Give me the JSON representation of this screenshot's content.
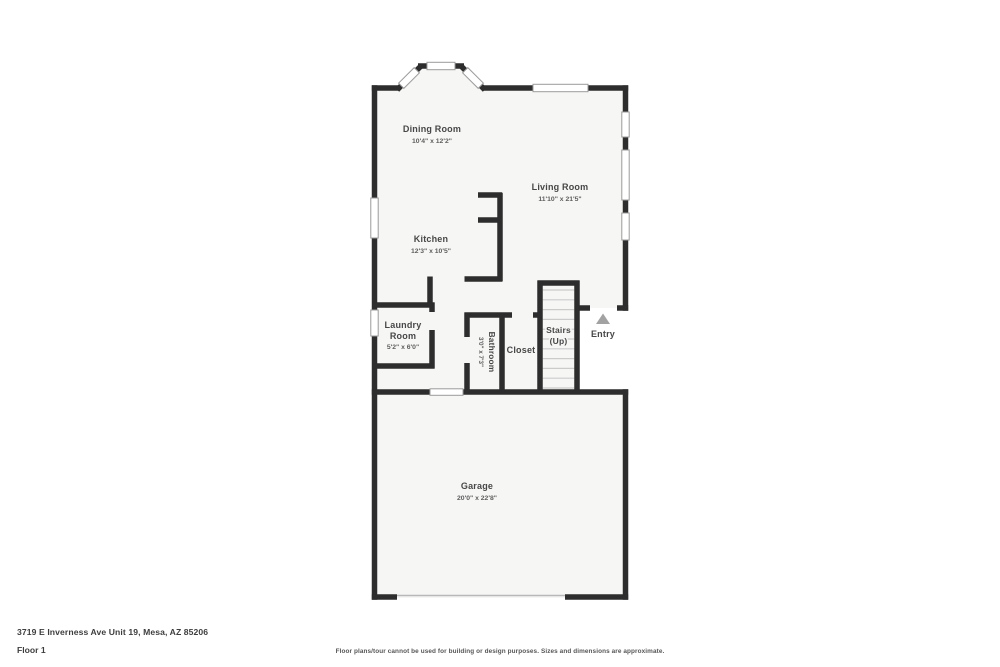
{
  "page": {
    "background_color": "#ffffff"
  },
  "floor_plan": {
    "colors": {
      "wall": "#2d2d2d",
      "floor": "#f6f6f5",
      "window_outline": "#9b9b9b",
      "stair_tread": "#cbcbcb",
      "entry_arrow": "#a2a2a2",
      "label_text": "#474747"
    },
    "rooms": {
      "dining": {
        "name": "Dining Room",
        "dims": "10'4\" x 12'2\""
      },
      "living": {
        "name": "Living Room",
        "dims": "11'10\" x 21'5\""
      },
      "kitchen": {
        "name": "Kitchen",
        "dims": "12'3\" x 10'5\""
      },
      "laundry": {
        "name_line1": "Laundry",
        "name_line2": "Room",
        "dims": "5'2\" x 6'0\""
      },
      "bathroom": {
        "name": "Bathroom",
        "dims": "3'0\" x 7'3\""
      },
      "closet": {
        "name": "Closet"
      },
      "stairs": {
        "name_line1": "Stairs",
        "name_line2": "(Up)"
      },
      "garage": {
        "name": "Garage",
        "dims": "20'0\" x 22'8\""
      }
    },
    "entry": {
      "label": "Entry"
    }
  },
  "footer": {
    "address": "3719 E Inverness Ave Unit 19, Mesa, AZ 85206",
    "floor_label": "Floor 1",
    "disclaimer": "Floor plans/tour cannot be used for building or design purposes. Sizes and dimensions are approximate."
  }
}
